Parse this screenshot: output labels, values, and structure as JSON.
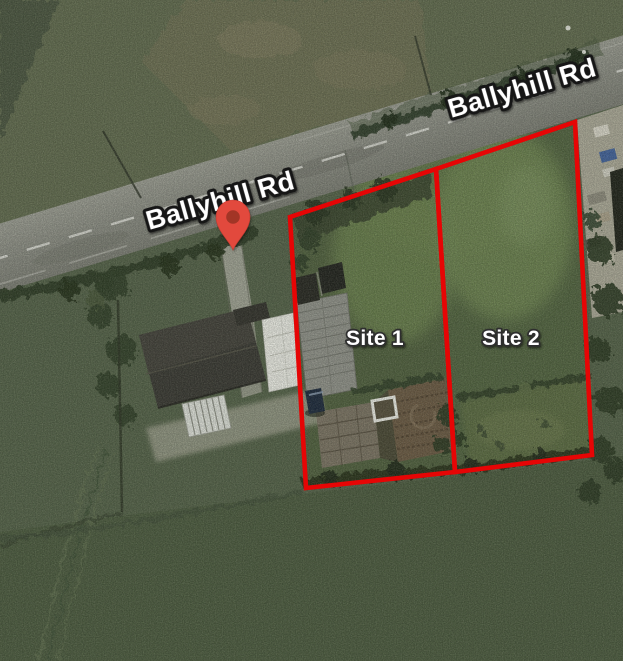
{
  "road": {
    "name": "Ballyhill Rd",
    "labels": [
      {
        "text": "Ballyhill Rd"
      },
      {
        "text": "Ballyhill Rd"
      }
    ]
  },
  "sites": [
    {
      "label": "Site 1"
    },
    {
      "label": "Site 2"
    }
  ],
  "marker": {
    "kind": "red-location-pin",
    "body_color": "#e2493e",
    "inner_color": "#a23427"
  },
  "colors": {
    "site_boundary": "#e60505",
    "label_fill": "#ffffff",
    "road_label_outline": "#141414",
    "site_label_outline": "#2e2e2e"
  }
}
